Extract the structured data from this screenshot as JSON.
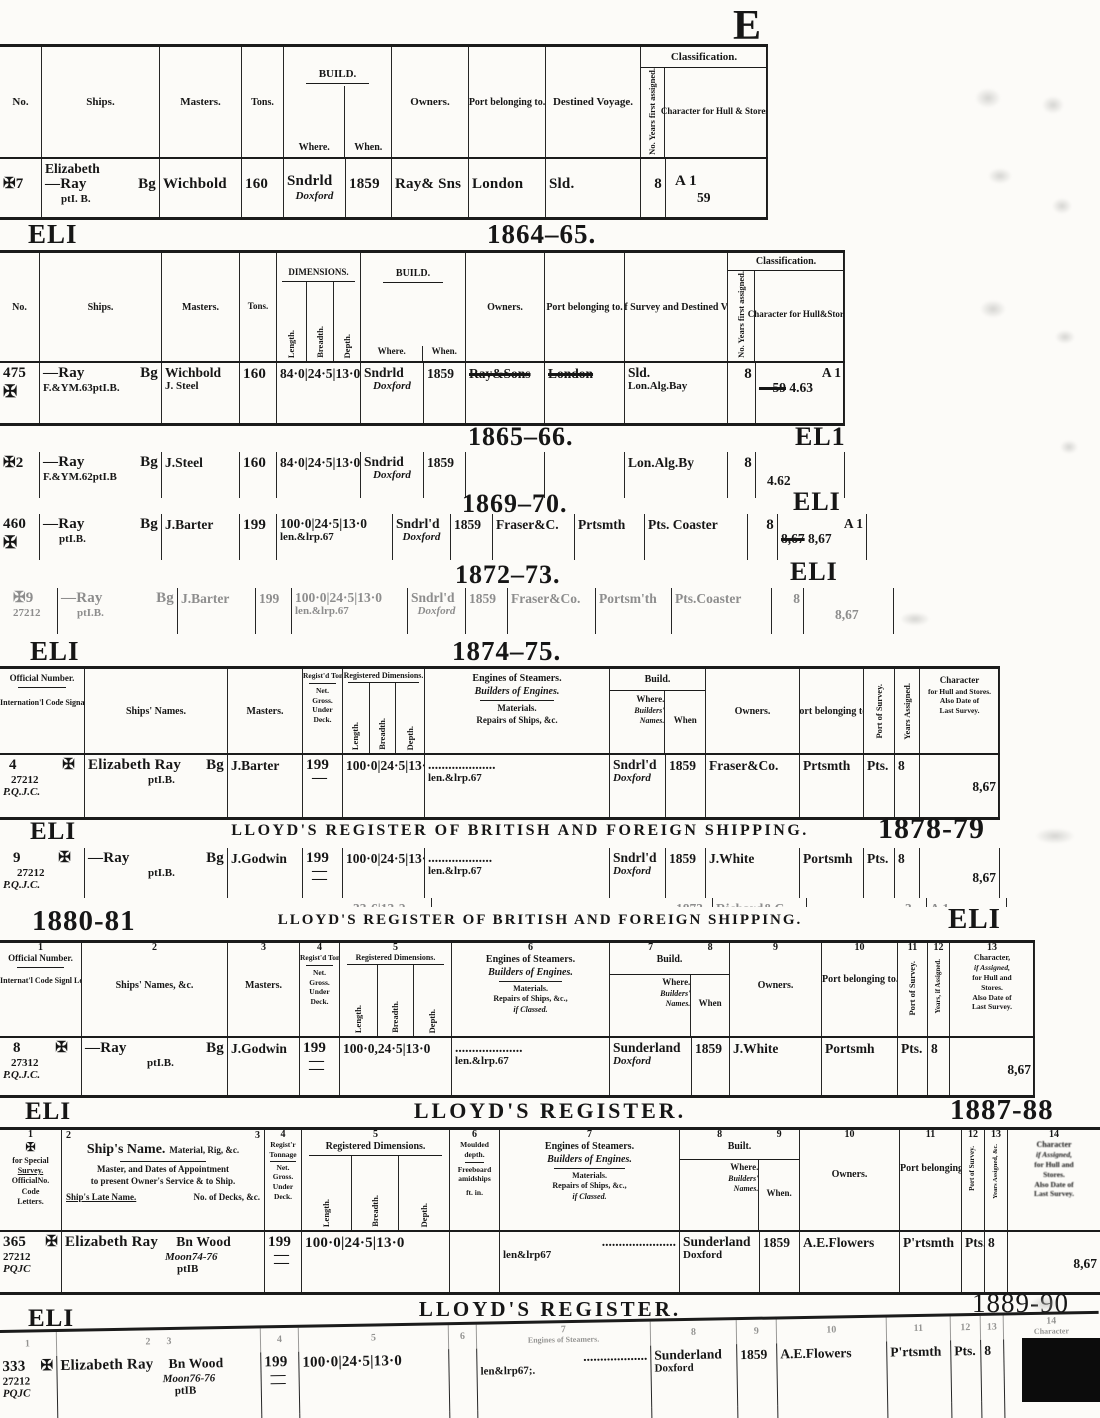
{
  "page": {
    "corner_letter": "E"
  },
  "s1": {
    "h": {
      "no": "No.",
      "ships": "Ships.",
      "masters": "Masters.",
      "tons": "Tons.",
      "build": "BUILD.",
      "where": "Where.",
      "when": "When.",
      "owners": "Owners.",
      "port": "Port belonging to.",
      "voyage": "Destined Voyage.",
      "cls": "Classification.",
      "years": "No. Years first assigned.",
      "character": "Character for Hull & Stores."
    },
    "r": {
      "no": "✠7",
      "name_top": "Elizabeth",
      "name": "—Ray",
      "rig": "Bg",
      "name_sub": "ptI. B.",
      "master": "Wichbold",
      "tons": "160",
      "where": "Sndrld",
      "builder": "Doxford",
      "when": "1859",
      "owners": "Ray& Sns",
      "port": "London",
      "voyage": "Sld.",
      "years": "8",
      "char": "A 1",
      "char_date": "59"
    }
  },
  "s2": {
    "eli": "ELI",
    "year": "1864–65.",
    "h": {
      "no": "No.",
      "ships": "Ships.",
      "masters": "Masters.",
      "tons": "Tons.",
      "dims": "DIMENSIONS.",
      "length": "Length.",
      "breadth": "Breadth.",
      "depth": "Depth.",
      "build": "BUILD.",
      "where": "Where.",
      "when": "When.",
      "owners": "Owners.",
      "port": "Port belonging to.",
      "survey": "Port of Survey and Destined Voyage.",
      "cls": "Classification.",
      "years": "No. Years first assigned.",
      "character": "Character for Hull&Stores"
    },
    "r": {
      "no": "475",
      "cross": "✠",
      "name": "—Ray",
      "rig": "Bg",
      "name_sub": "F.&YM.63ptI.B.",
      "master": "Wichbold",
      "master2": "J. Steel",
      "tons": "160",
      "dims": "84·0|24·5|13·0",
      "where": "Sndrld",
      "builder": "Doxford",
      "when": "1859",
      "owners": "Ray&Sons",
      "port": "London",
      "voyage": "Sld.",
      "voyage2": "Lon.Alg.Bay",
      "years": "8",
      "char_struck": "—59",
      "char": "A 1",
      "char_date": "4.63"
    }
  },
  "s3": {
    "year": "1865–66.",
    "eli": "EL1",
    "r": {
      "no": "✠2",
      "name": "—Ray",
      "rig": "Bg",
      "name_sub": "F.&YM.62ptI.B",
      "master": "J.Steel",
      "tons": "160",
      "dims": "84·0|24·5|13·0",
      "where": "Sndrid",
      "builder": "Doxford",
      "when": "1859",
      "voyage": "Lon.Alg.By",
      "years": "8",
      "char_date": "4.62"
    }
  },
  "s4": {
    "year": "1869–70.",
    "eli": "ELI",
    "r": {
      "no": "460",
      "cross": "✠",
      "name": "—Ray",
      "rig": "Bg",
      "name_sub": "ptI.B.",
      "master": "J.Barter",
      "tons": "199",
      "dims": "100·0|24·5|13·0",
      "dims_sub": "len.&lrp.67",
      "where": "Sndrl'd",
      "builder": "Doxford",
      "when": "1859",
      "owners": "Fraser&C.",
      "port": "Prtsmth",
      "voyage": "Pts. Coaster",
      "years": "8",
      "char": "A 1",
      "char_struck": "8,67",
      "char_date": "8,67"
    }
  },
  "s5": {
    "year": "1872–73.",
    "eli": "ELI",
    "r": {
      "no": "✠9",
      "no2": "27212",
      "name": "—Ray",
      "rig": "Bg",
      "name_sub": "ptI.B.",
      "master": "J.Barter",
      "tons": "199",
      "dims": "100·0|24·5|13·0",
      "dims_sub": "len.&lrp.67",
      "where": "Sndrl'd",
      "builder": "Doxford",
      "when": "1859",
      "owners": "Fraser&Co.",
      "port": "Portsm'th",
      "voyage": "Pts.Coaster",
      "years": "8",
      "char_date": "8,67"
    }
  },
  "s6": {
    "eli": "ELI",
    "year": "1874–75.",
    "h": {
      "c1a": "Official Number.",
      "c1b": "Internation'l Code Signal Letters.",
      "names": "Ships' Names.",
      "masters": "Masters.",
      "ton1": "Regist'd Tonnage",
      "ton2": "Net.",
      "ton3": "Gross.",
      "ton4": "Under",
      "ton5": "Deck.",
      "dims": "Registered Dimensions.",
      "length": "Length.",
      "breadth": "Breadth.",
      "depth": "Depth.",
      "eng1": "Engines of Steamers.",
      "eng2": "Builders of Engines.",
      "eng3": "Materials.",
      "eng4": "Repairs of Ships, &c.",
      "build": "Build.",
      "where1": "Where.",
      "where2": "Builders'",
      "where3": "Names.",
      "when": "When",
      "owners": "Owners.",
      "port": "Port belonging to.",
      "survey": "Port of Survey.",
      "years": "Years Assigned.",
      "char1": "Character",
      "char2": "for Hull and Stores.",
      "char3": "Also Date of",
      "char4": "Last Survey."
    },
    "r": {
      "no": "4",
      "cross": "✠",
      "no2": "27212",
      "no3": "P.Q.J.C.",
      "name": "Elizabeth Ray",
      "rig": "Bg",
      "name_sub": "ptI.B.",
      "master": "J.Barter",
      "tons": "199",
      "ton_dash": "—",
      "dims": "100·0|24·5|13·0",
      "dots": "....................",
      "dots_sub": "len.&lrp.67",
      "where": "Sndrl'd",
      "builder": "Doxford",
      "when": "1859",
      "owners": "Fraser&Co.",
      "port": "Prtsmth",
      "survey": "Pts.",
      "years": "8",
      "char": "8,67"
    }
  },
  "s7": {
    "eli": "ELI",
    "title": "LLOYD'S REGISTER OF BRITISH AND FOREIGN SHIPPING.",
    "year": "1878-79",
    "r": {
      "no": "9",
      "cross": "✠",
      "no2": "27212",
      "no3": "P.Q.J.C.",
      "name": "—Ray",
      "rig": "Bg",
      "name_sub": "ptI.B.",
      "master": "J.Godwin",
      "tons": "199",
      "ton_dash": "—",
      "ton_dash2": "—",
      "dims": "100·0|24·5|13·0",
      "dots": "...................",
      "dots_sub": "len.&lrp.67",
      "where": "Sndrl'd",
      "builder": "Doxford",
      "when": "1859",
      "owners": "J.White",
      "port": "Portsmh",
      "survey": "Pts.",
      "years": "8",
      "char": "8,67"
    },
    "frag": {
      "dims": "33·6|13·2",
      "when": "1873",
      "owners": "Richard&C",
      "char": "A 1",
      "years": "3"
    }
  },
  "s8": {
    "year": "1880-81",
    "title": "LLOYD'S REGISTER OF BRITISH AND FOREIGN SHIPPING.",
    "eli": "ELI",
    "nums": [
      "1",
      "2",
      "3",
      "4",
      "5",
      "6",
      "7",
      "8",
      "9",
      "10",
      "11",
      "12",
      "13"
    ],
    "h": {
      "c1a": "Official Number.",
      "c1b": "Internat'l Code Signl Letters.",
      "names": "Ships' Names, &c.",
      "masters": "Masters.",
      "ton1": "Regist'd Tonnage",
      "ton2": "Net.",
      "ton3": "Gross.",
      "ton4": "Under",
      "ton5": "Deck.",
      "dims": "Registered Dimensions.",
      "length": "Length.",
      "breadth": "Breadth.",
      "depth": "Depth.",
      "eng1": "Engines of Steamers.",
      "eng2": "Builders of Engines.",
      "eng3": "Materials.",
      "eng4": "Repairs of Ships, &c.,",
      "eng5": "if Classed.",
      "build": "Build.",
      "where1": "Where.",
      "where2": "Builders'",
      "where3": "Names.",
      "when": "When",
      "owners": "Owners.",
      "port": "Port belonging to.",
      "survey": "Port of Survey.",
      "years": "Years, if Assigned.",
      "char1": "Character,",
      "char2": "if Assigned,",
      "char3": "for Hull and",
      "char4": "Stores.",
      "char5": "Also Date of",
      "char6": "Last Survey."
    },
    "r": {
      "no": "8",
      "cross": "✠",
      "no2": "27312",
      "no3": "P.Q.J.C.",
      "name": "—Ray",
      "rig": "Bg",
      "name_sub": "ptI.B.",
      "master": "J.Godwin",
      "tons": "199",
      "ton_dash": "—",
      "ton_dash2": "—",
      "dims": "100·0,24·5|13·0",
      "dots": "....................",
      "dots_sub": "len.&lrp.67",
      "where": "Sunderland",
      "builder": "Doxford",
      "when": "1859",
      "owners": "J.White",
      "port": "Portsmh",
      "survey": "Pts.",
      "years": "8",
      "char": "8,67"
    }
  },
  "s9": {
    "eli": "ELI",
    "title": "LLOYD'S REGISTER.",
    "year": "1887-88",
    "nums": [
      "1",
      "2",
      "3",
      "4",
      "5",
      "6",
      "7",
      "8",
      "9",
      "10",
      "11",
      "12",
      "13",
      "14"
    ],
    "h": {
      "c1a": "for Special",
      "c1b": "Survey.",
      "c1c": "OfficialNo.",
      "c1d": "Code",
      "c1e": "Letters.",
      "name1": "Ship's Name.",
      "name1b": "Material, Rig, &c.",
      "name2": "Master, and Dates of Appointment",
      "name2b": "to present Owner's Service & to Ship.",
      "name3": "Ship's Late Name.",
      "name3b": "No. of Decks, &c.",
      "ton1": "Regist'r",
      "ton2": "Tonnage",
      "ton3": "Net.",
      "ton4": "Gross.",
      "ton5": "Under",
      "ton6": "Deck.",
      "dims": "Registered Dimensions.",
      "length": "Length.",
      "breadth": "Breadth.",
      "depth": "Depth.",
      "mld1": "Moulded",
      "mld2": "depth.",
      "mld3": "Freeboard",
      "mld4": "amidships",
      "mld5": "ft. in.",
      "eng1": "Engines of Steamers.",
      "eng2": "Builders of Engines.",
      "eng3": "Materials.",
      "eng4": "Repairs of Ships, &c.,",
      "eng5": "if Classed.",
      "built": "Built.",
      "where1": "Where.",
      "where2": "Builders'",
      "where3": "Names.",
      "when": "When.",
      "owners": "Owners.",
      "port": "Port belonging to.",
      "survey": "Port of Survey.",
      "years": "Years Assigned, &c.",
      "char1": "Character",
      "char2": "if Assigned,",
      "char3": "for Hull and",
      "char4": "Stores.",
      "char5": "Also Date of",
      "char6": "Last Survey."
    },
    "r": {
      "no": "365",
      "cross": "✠",
      "no2": "27212",
      "no3": "PQJC",
      "name": "Elizabeth Ray",
      "rig": "Bn Wood",
      "name2": "Moon74-76",
      "name3": "ptIB",
      "tons": "199",
      "ton_dash": "—",
      "ton_dash2": "—",
      "dims": "100·0|24·5|13·0",
      "dots": "......................",
      "dots_sub": "len&lrp67",
      "where": "Sunderland",
      "builder": "Doxford",
      "when": "1859",
      "owners": "A.E.Flowers",
      "port": "P'rtsmth",
      "survey": "Pts.",
      "years": "8",
      "char": "8,67"
    }
  },
  "s10": {
    "eli": "ELI",
    "title": "LLOYD'S REGISTER.",
    "year": "1889-90",
    "nums": [
      "1",
      "2",
      "3",
      "4",
      "5",
      "6",
      "7",
      "8",
      "9",
      "10",
      "11",
      "12",
      "13",
      "14"
    ],
    "h": {
      "eng": "Engines of Steamers.",
      "character": "Character"
    },
    "r": {
      "no": "333",
      "cross": "✠",
      "no2": "27212",
      "no3": "PQJC",
      "name": "Elizabeth Ray",
      "rig": "Bn Wood",
      "name2": "Moon76-76",
      "name3": "ptIB",
      "tons": "199",
      "ton_dash": "—",
      "ton_dash2": "—",
      "dims": "100·0|24·5|13·0",
      "dots": "...................",
      "dots_sub": "len&lrp67;.",
      "where": "Sunderland",
      "builder": "Doxford",
      "when": "1859",
      "owners": "A.E.Flowers",
      "port": "P'rtsmth",
      "survey": "Pts.",
      "years": "8",
      "char": "8,67"
    },
    "r2": {
      "when": "1870",
      "owners": "J.Harvey",
      "port": "Arbro'th",
      "survey": "Mtr.",
      "years": "11"
    }
  }
}
